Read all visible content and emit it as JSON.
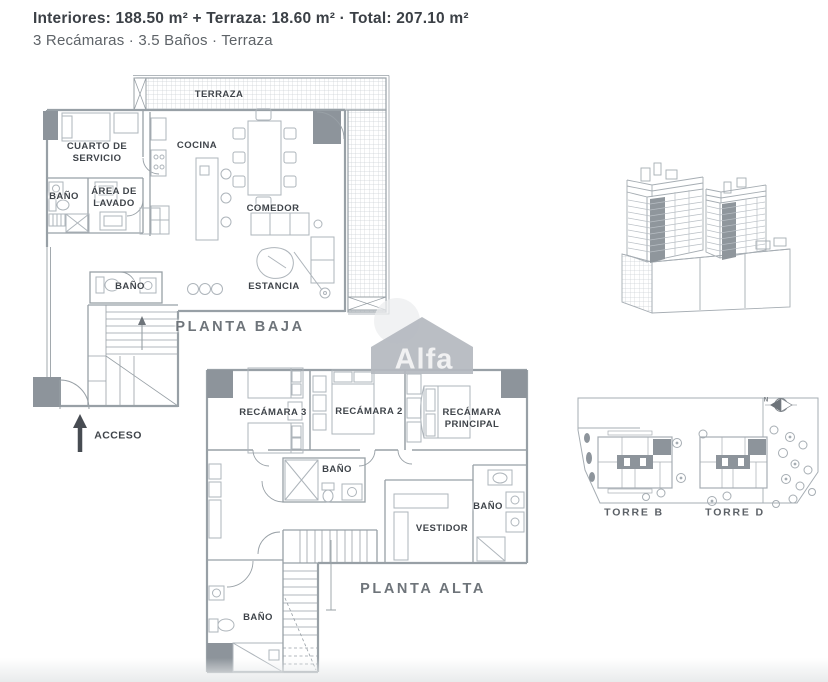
{
  "header": {
    "specs_line": "Interiores: 188.50 m² + Terraza: 18.60 m² · Total: 207.10 m²",
    "features_line": "3 Recámaras · 3.5 Baños · Terraza"
  },
  "watermark": {
    "brand": "Alfa"
  },
  "planta_baja": {
    "title": "PLANTA BAJA",
    "access": "ACCESO",
    "rooms": [
      "TERRAZA",
      "CUARTO DE SERVICIO",
      "COCINA",
      "BAÑO",
      "ÁREA DE LAVADO",
      "COMEDOR",
      "BAÑO",
      "ESTANCIA"
    ]
  },
  "planta_alta": {
    "title": "PLANTA ALTA",
    "rooms": [
      "RECÁMARA 3",
      "RECÁMARA 2",
      "RECÁMARA PRINCIPAL",
      "BAÑO",
      "BAÑO",
      "VESTIDOR",
      "BAÑO"
    ]
  },
  "site_plan": {
    "north": "N",
    "towers": [
      "TORRE B",
      "TORRE D"
    ]
  },
  "colors": {
    "wall": "#98a0a6",
    "furniture": "#aeb5bb",
    "shear_wall": "#8d949b",
    "hatch": "#cdd2d6",
    "text_dark": "#3f444a",
    "text_muted": "#6e747a",
    "watermark_gray": "#b5b9bf",
    "background": "#ffffff"
  }
}
